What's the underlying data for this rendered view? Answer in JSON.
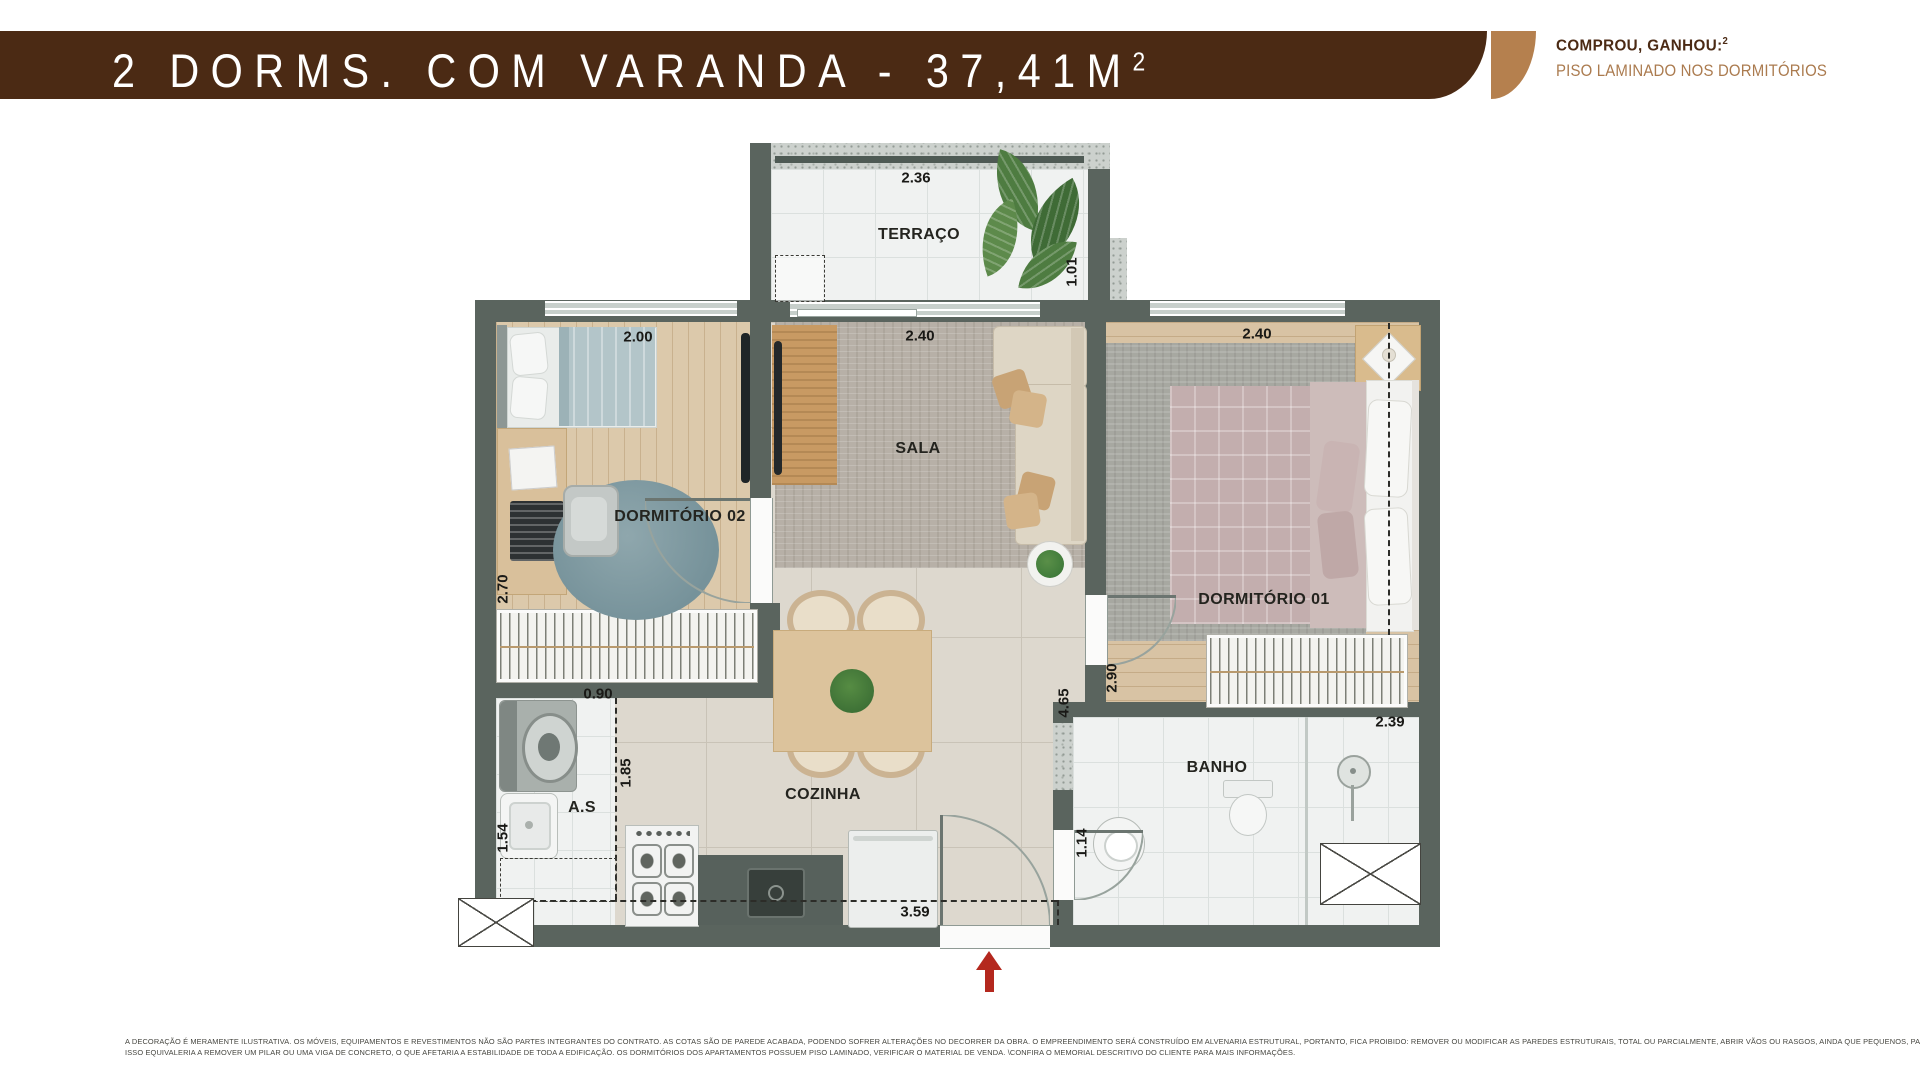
{
  "header": {
    "title": "2 DORMS. COM VARANDA - 37,41M",
    "title_sup": "2",
    "promo_title": "COMPROU, GANHOU:",
    "promo_sup": "2",
    "promo_subtitle": "PISO LAMINADO NOS DORMITÓRIOS"
  },
  "plan": {
    "labels": {
      "terraco": "TERRAÇO",
      "sala": "SALA",
      "dorm2": "DORMITÓRIO 02",
      "dorm1": "DORMITÓRIO 01",
      "cozinha": "COZINHA",
      "as": "A.S",
      "banho": "BANHO"
    },
    "dims": {
      "terraco_w": "2.36",
      "terraco_s": "1.01",
      "dorm2_w": "2.00",
      "sala_w": "2.40",
      "dorm1_w": "2.40",
      "dorm2_h": "2.70",
      "as_w": "0.90",
      "as_coz": "1.85",
      "as_h": "1.54",
      "coz_h": "4.65",
      "dorm1_h": "2.90",
      "banho_w": "2.39",
      "banho_h": "1.14",
      "coz_w": "3.59"
    }
  },
  "footer": {
    "line1": "A DECORAÇÃO É MERAMENTE ILUSTRATIVA. OS MÓVEIS, EQUIPAMENTOS E REVESTIMENTOS NÃO SÃO PARTES INTEGRANTES DO CONTRATO. AS COTAS SÃO DE PAREDE ACABADA, PODENDO SOFRER ALTERAÇÕES NO DECORRER DA OBRA. O EMPREENDIMENTO SERÁ CONSTRUÍDO EM ALVENARIA ESTRUTURAL, PORTANTO, FICA PROIBIDO: REMOVER OU MODIFICAR AS PAREDES ESTRUTURAIS, TOTAL OU PARCIALMENTE, ABRIR VÃOS OU RASGOS, AINDA QUE PEQUENOS, PARA QUALQUER INSTALAÇÃO, OU PERMITIR QUE TERCEIROS O FAÇAM",
    "line2": "ISSO EQUIVALERIA A REMOVER UM PILAR OU UMA VIGA DE CONCRETO, O QUE AFETARIA A ESTABILIDADE DE TODA A EDIFICAÇÃO. OS DORMITÓRIOS DOS APARTAMENTOS POSSUEM PISO LAMINADO, VERIFICAR O MATERIAL DE VENDA. \\CONFIRA O MEMORIAL DESCRITIVO DO CLIENTE PARA MAIS INFORMAÇÕES."
  },
  "colors": {
    "banner": "#4b2a14",
    "accent": "#b5804e",
    "arrow_red": "#b4281e",
    "wall": "#5a645e"
  }
}
